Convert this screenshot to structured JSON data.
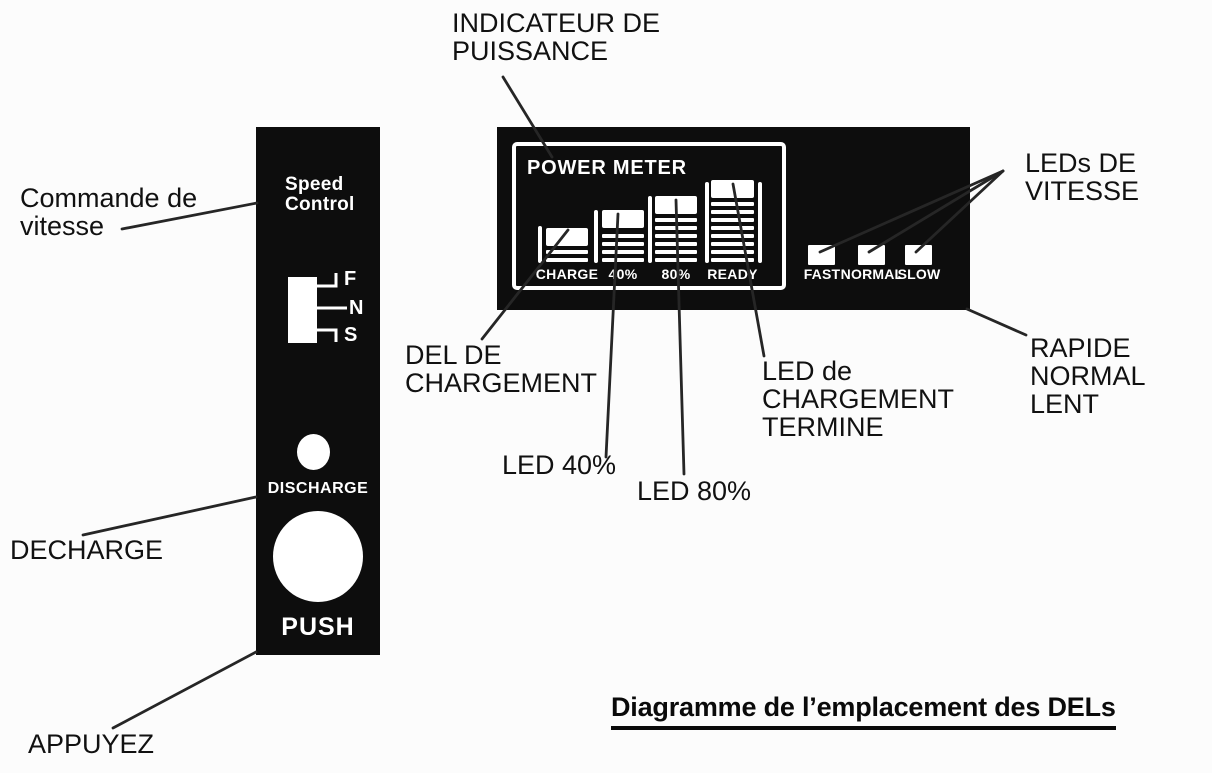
{
  "title": "Diagramme de l’emplacement des DELs",
  "left_panel": {
    "label": "Speed\nControl",
    "switch_positions": [
      "F",
      "N",
      "S"
    ],
    "discharge": "DISCHARGE",
    "push": "PUSH"
  },
  "meter_panel": {
    "title": "POWER METER",
    "columns": [
      {
        "label": "CHARGE",
        "bars": 2
      },
      {
        "label": "40%",
        "bars": 4
      },
      {
        "label": "80%",
        "bars": 6
      },
      {
        "label": "READY",
        "bars": 8
      }
    ],
    "speed_leds": [
      "FAST",
      "NORMAL",
      "SLOW"
    ]
  },
  "callouts": [
    {
      "id": "commande-de-vitesse",
      "text": "Commande de\nvitesse"
    },
    {
      "id": "indicateur-de-puissance",
      "text": "INDICATEUR DE\nPUISSANCE"
    },
    {
      "id": "leds-de-vitesse",
      "text": "LEDs DE\nVITESSE"
    },
    {
      "id": "del-de-chargement",
      "text": "DEL DE\nCHARGEMENT"
    },
    {
      "id": "led-40",
      "text": "LED 40%"
    },
    {
      "id": "led-80",
      "text": "LED 80%"
    },
    {
      "id": "led-chargement-termine",
      "text": "LED de\nCHARGEMENT\nTERMINE"
    },
    {
      "id": "rapide-normal-lent",
      "text": "RAPIDE\nNORMAL\nLENT"
    },
    {
      "id": "decharge",
      "text": "DECHARGE"
    },
    {
      "id": "appuyez",
      "text": "APPUYEZ"
    }
  ],
  "colors": {
    "panel": "#0d0d0d",
    "leader_line": "#262626",
    "text": "#111111",
    "white": "#ffffff"
  }
}
